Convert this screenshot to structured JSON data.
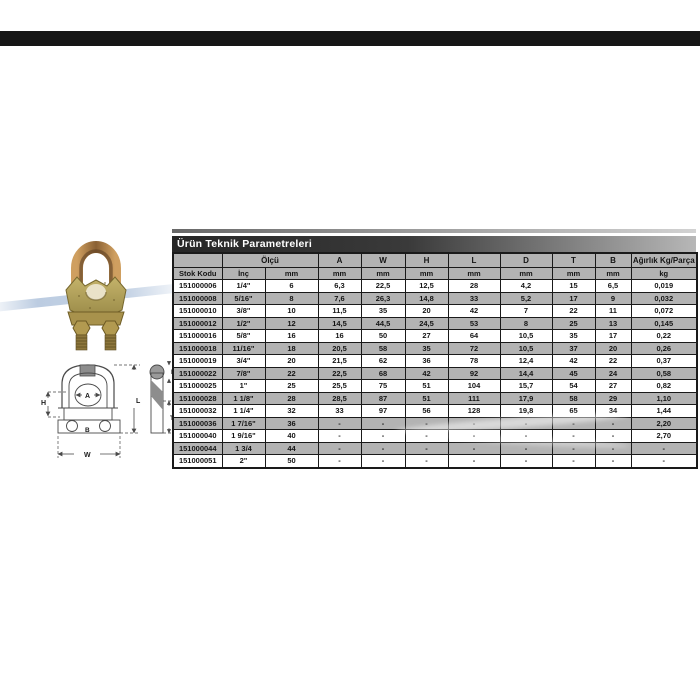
{
  "colors": {
    "top_bar": "#161616",
    "title_bar_dark": "#262626",
    "table_gray": "#b3b3b3",
    "table_border": "#1a1a1a",
    "swoosh_blue": "#8faacd",
    "clip_bronze": "#b58a4e",
    "clip_olive": "#b3a45e"
  },
  "table": {
    "title": "Ürün Teknik Parametreleri",
    "header": {
      "group_olcu": "Ölçü",
      "stok_kodu": "Stok Kodu",
      "inc": "İnç",
      "mm": "mm",
      "kg": "kg",
      "weight": "Ağırlık Kg/Parça",
      "dims": [
        "A",
        "W",
        "H",
        "L",
        "D",
        "T",
        "B"
      ]
    },
    "rows": [
      [
        "151000006",
        "1/4\"",
        "6",
        "6,3",
        "22,5",
        "12,5",
        "28",
        "4,2",
        "15",
        "6,5",
        "0,019"
      ],
      [
        "151000008",
        "5/16\"",
        "8",
        "7,6",
        "26,3",
        "14,8",
        "33",
        "5,2",
        "17",
        "9",
        "0,032"
      ],
      [
        "151000010",
        "3/8\"",
        "10",
        "11,5",
        "35",
        "20",
        "42",
        "7",
        "22",
        "11",
        "0,072"
      ],
      [
        "151000012",
        "1/2\"",
        "12",
        "14,5",
        "44,5",
        "24,5",
        "53",
        "8",
        "25",
        "13",
        "0,145"
      ],
      [
        "151000016",
        "5/8\"",
        "16",
        "16",
        "50",
        "27",
        "64",
        "10,5",
        "35",
        "17",
        "0,22"
      ],
      [
        "151000018",
        "11/16\"",
        "18",
        "20,5",
        "58",
        "35",
        "72",
        "10,5",
        "37",
        "20",
        "0,26"
      ],
      [
        "151000019",
        "3/4\"",
        "20",
        "21,5",
        "62",
        "36",
        "78",
        "12,4",
        "42",
        "22",
        "0,37"
      ],
      [
        "151000022",
        "7/8\"",
        "22",
        "22,5",
        "68",
        "42",
        "92",
        "14,4",
        "45",
        "24",
        "0,58"
      ],
      [
        "151000025",
        "1\"",
        "25",
        "25,5",
        "75",
        "51",
        "104",
        "15,7",
        "54",
        "27",
        "0,82"
      ],
      [
        "151000028",
        "1 1/8\"",
        "28",
        "28,5",
        "87",
        "51",
        "111",
        "17,9",
        "58",
        "29",
        "1,10"
      ],
      [
        "151000032",
        "1 1/4\"",
        "32",
        "33",
        "97",
        "56",
        "128",
        "19,8",
        "65",
        "34",
        "1,44"
      ],
      [
        "151000036",
        "1 7/16\"",
        "36",
        "-",
        "-",
        "-",
        "-",
        "-",
        "-",
        "-",
        "2,20"
      ],
      [
        "151000040",
        "1 9/16\"",
        "40",
        "-",
        "-",
        "-",
        "-",
        "-",
        "-",
        "-",
        "2,70"
      ],
      [
        "151000044",
        "1 3/4",
        "44",
        "-",
        "-",
        "-",
        "-",
        "-",
        "-",
        "-",
        "-"
      ],
      [
        "151000051",
        "2\"",
        "50",
        "-",
        "-",
        "-",
        "-",
        "-",
        "-",
        "-",
        "-"
      ]
    ]
  },
  "drawing": {
    "labels": {
      "A": "A",
      "H": "H",
      "B": "B",
      "L": "L",
      "W": "W",
      "D": "D",
      "T": "T"
    }
  }
}
